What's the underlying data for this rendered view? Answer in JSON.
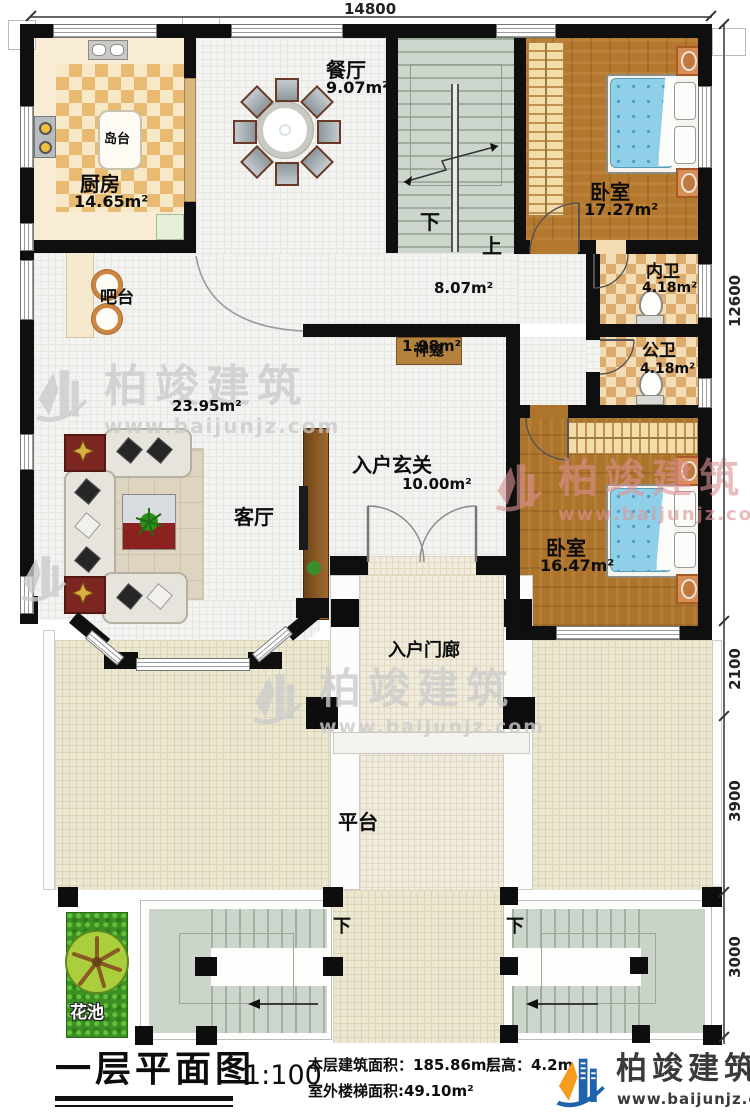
{
  "plan_title": "一层平面图",
  "scale": "1:100",
  "stats": {
    "floor_area": "本层建筑面积：185.86m²",
    "floor_height": "层高：4.2m",
    "outdoor_stair_area": "室外楼梯面积:49.10m²"
  },
  "brand": {
    "name": "柏竣建筑",
    "website": "www.baijunjz.com"
  },
  "watermark": {
    "name": "柏竣建筑",
    "website": "www.baijunjz.com"
  },
  "dimensions": {
    "top_width": "14800",
    "right_total": "12600",
    "right_seg1": "2100",
    "right_seg2": "3900",
    "right_seg3": "3000"
  },
  "rooms": {
    "kitchen": {
      "label": "厨房",
      "area": "14.65m²"
    },
    "island": {
      "label": "岛台"
    },
    "dining": {
      "label": "餐厅",
      "area": "9.07m²"
    },
    "bedroom_top": {
      "label": "卧室",
      "area": "17.27m²"
    },
    "bedroom_bottom": {
      "label": "卧室",
      "area": "16.47m²"
    },
    "inner_bath": {
      "label": "内卫",
      "area": "4.18m²"
    },
    "public_bath": {
      "label": "公卫",
      "area": "4.18m²"
    },
    "bar": {
      "label": "吧台"
    },
    "shrine": {
      "label": "神龛"
    },
    "living": {
      "label": "客厅",
      "area": "23.95m²"
    },
    "hallway": {
      "area": "8.07m²"
    },
    "bath_hall": {
      "area": "1.98m²"
    },
    "foyer": {
      "label": "入户玄关",
      "area": "10.00m²"
    },
    "porch": {
      "label": "入户门廊"
    },
    "platform": {
      "label": "平台"
    },
    "flower_bed": {
      "label": "花池"
    },
    "stair_down": "下",
    "stair_up": "上"
  },
  "colors": {
    "wall": "#0f0f0f",
    "brand_blue": "#1f63ac",
    "brand_orange": "#f59b1e",
    "bed_blue": "#8fd0e8",
    "tile_accent": "#e9ba72"
  }
}
